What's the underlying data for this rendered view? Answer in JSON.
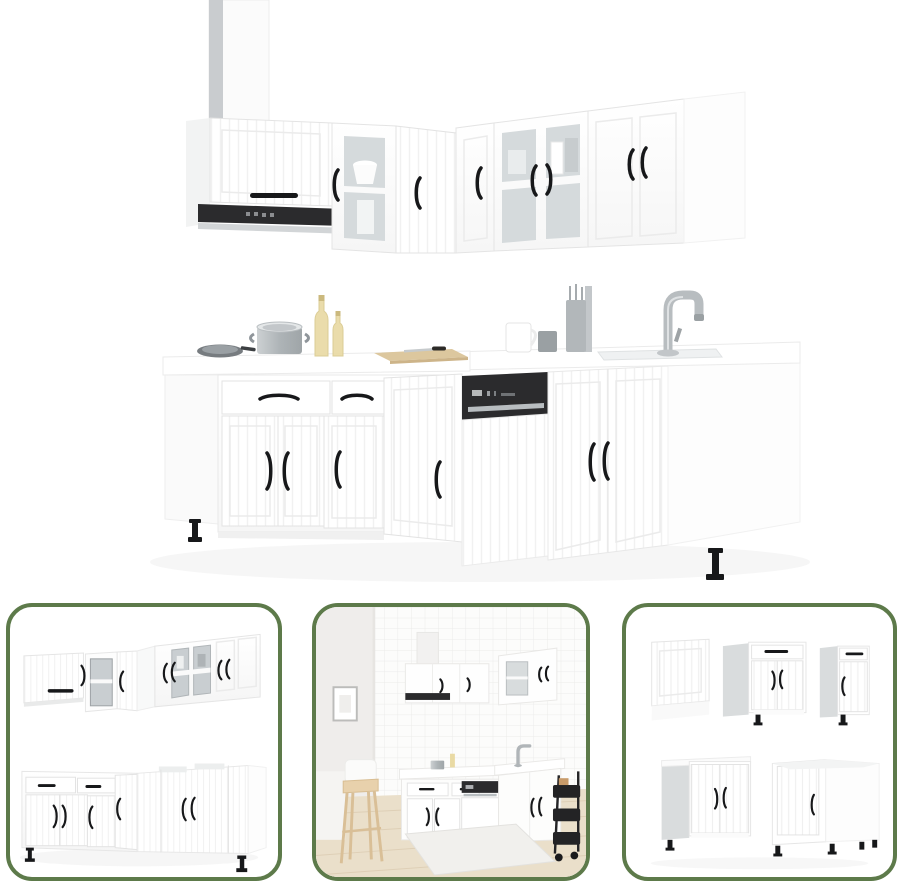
{
  "gallery": {
    "main_image": {
      "name": "kitchen-set-main-photo"
    },
    "thumbnails": [
      {
        "name": "kitchen-set-angle-view"
      },
      {
        "name": "kitchen-set-room-scene"
      },
      {
        "name": "kitchen-set-individual-units"
      }
    ]
  },
  "palette": {
    "accent_green": "#5d7a4a",
    "cabinet_white": "#ffffff",
    "cabinet_line": "#e6e6e6",
    "rib_line": "#f0f0f0",
    "side_panel": "#f2f3f3",
    "bright_panel": "#fdfdfd",
    "glass_gray": "#d5dadc",
    "panel_gray": "#c9cccf",
    "handle_black": "#17181a",
    "appliance_black": "#2b2b2d",
    "steel_gray": "#b8bdc0",
    "bottle_yellow": "#e9daa4",
    "wood_beige": "#dcc79e",
    "floor_wood": "#eadfca",
    "wall_gray": "#efedeb",
    "tile_line": "#ebebea",
    "soft_shadow": "#ededed"
  }
}
